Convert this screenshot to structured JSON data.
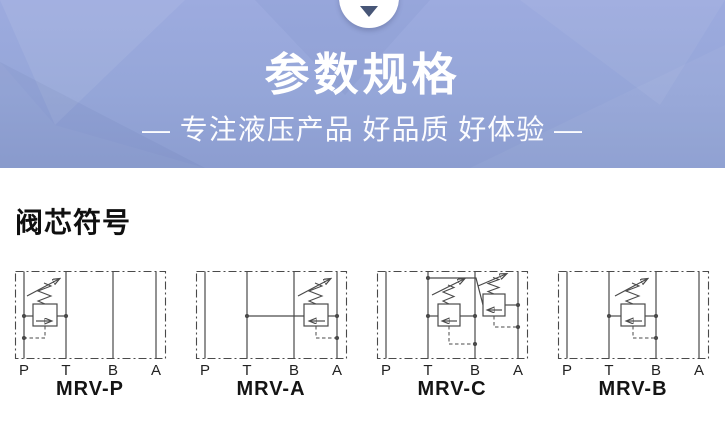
{
  "banner": {
    "title": "参数规格",
    "subtitle": "— 专注液压产品 好品质 好体验 —",
    "bg_color": "#95a6d8",
    "text_color": "#ffffff",
    "notch_icon": "chevron-down",
    "notch_arrow_color": "#475677"
  },
  "section": {
    "heading": "阀芯符号"
  },
  "diagram_style": {
    "line_color": "#4a4a4a",
    "port_label_color": "#222222",
    "name_color": "#141414"
  },
  "diagrams": [
    {
      "name": "MRV-P",
      "ports": [
        "P",
        "T",
        "B",
        "A"
      ]
    },
    {
      "name": "MRV-A",
      "ports": [
        "P",
        "T",
        "B",
        "A"
      ]
    },
    {
      "name": "MRV-C",
      "ports": [
        "P",
        "T",
        "B",
        "A"
      ]
    },
    {
      "name": "MRV-B",
      "ports": [
        "P",
        "T",
        "B",
        "A"
      ]
    }
  ]
}
